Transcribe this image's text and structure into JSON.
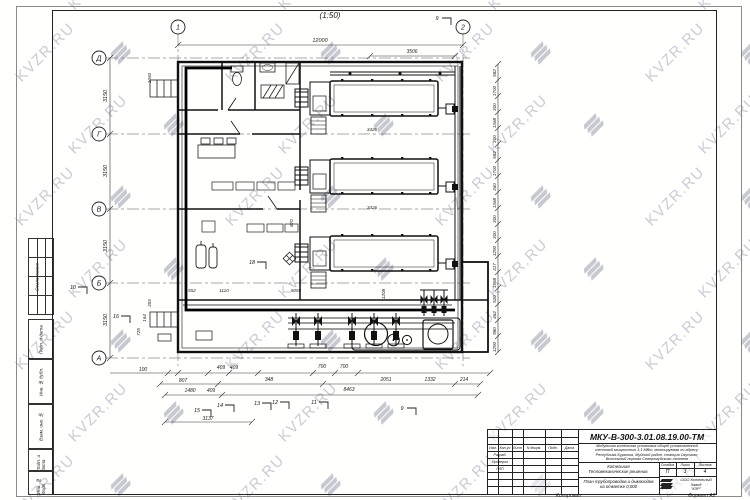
{
  "sheet": {
    "scale_label": "(1:50)",
    "copied_label": "Копировал",
    "format_label": "Формат А2"
  },
  "watermark": {
    "text": "KVZR.RU",
    "color": "#c9ccd3"
  },
  "side_column": {
    "approved_label": "Согласовано",
    "cells": [
      "Подп. и дата",
      "Инв. № дубл.",
      "Взам. инв. №",
      "Подп. и дата",
      "Инв. № подл."
    ]
  },
  "axes": {
    "cols": [
      "1",
      "2"
    ],
    "rows": [
      "Д",
      "Г",
      "В",
      "Б",
      "А"
    ]
  },
  "dims": {
    "top": [
      "12000",
      "3506"
    ],
    "left": [
      "3150",
      "3150",
      "3150",
      "3150"
    ],
    "right": [
      "582",
      "1700",
      "300",
      "1368",
      "300",
      "582",
      "1700",
      "360",
      "1368",
      "300",
      "300",
      "1290",
      "317",
      "1558",
      "520",
      "462",
      "980",
      "1290"
    ],
    "bottom": [
      "100",
      "409",
      "409",
      "700",
      "700",
      "807",
      "348",
      "2051",
      "1332",
      "214",
      "1480",
      "409",
      "8463",
      "3137"
    ],
    "interior": [
      "1060",
      "3426",
      "3426",
      "552",
      "1110",
      "5055",
      "1208",
      "870",
      "393",
      "164",
      "725"
    ]
  },
  "marks": [
    "9",
    "10",
    "11",
    "12",
    "13",
    "14",
    "15",
    "16",
    "18",
    "9"
  ],
  "title_block": {
    "doc_number": "МКУ-В-300-3.01.08.19.00-ТМ",
    "description": [
      "Модульная котельная установка общей установленной",
      "тепловой мощностью 3,1 МВт, монтируемая по адресу:",
      "Республика Бурятия, Муйский район, станция Окусикан,",
      "Восточный портал Северомуйского тоннеля"
    ],
    "object_line1": "Котельная",
    "object_line2": "Тепломеханические решения.",
    "sheet_title": [
      "План трубопроводов и дымоходов",
      "на отметке 0,000"
    ],
    "stage_cols": [
      "Стадия",
      "Лист",
      "Листов"
    ],
    "stage_vals": [
      "П",
      "3",
      "4"
    ],
    "company": [
      "ООО Котельный",
      "Завод",
      "\"КЗР\""
    ],
    "header_cols": [
      "Изм.",
      "Кол.уч",
      "Лист",
      "N докум.",
      "Подп.",
      "Дата"
    ],
    "roles": [
      "Разраб.",
      "Проверил",
      "ГИП"
    ]
  }
}
